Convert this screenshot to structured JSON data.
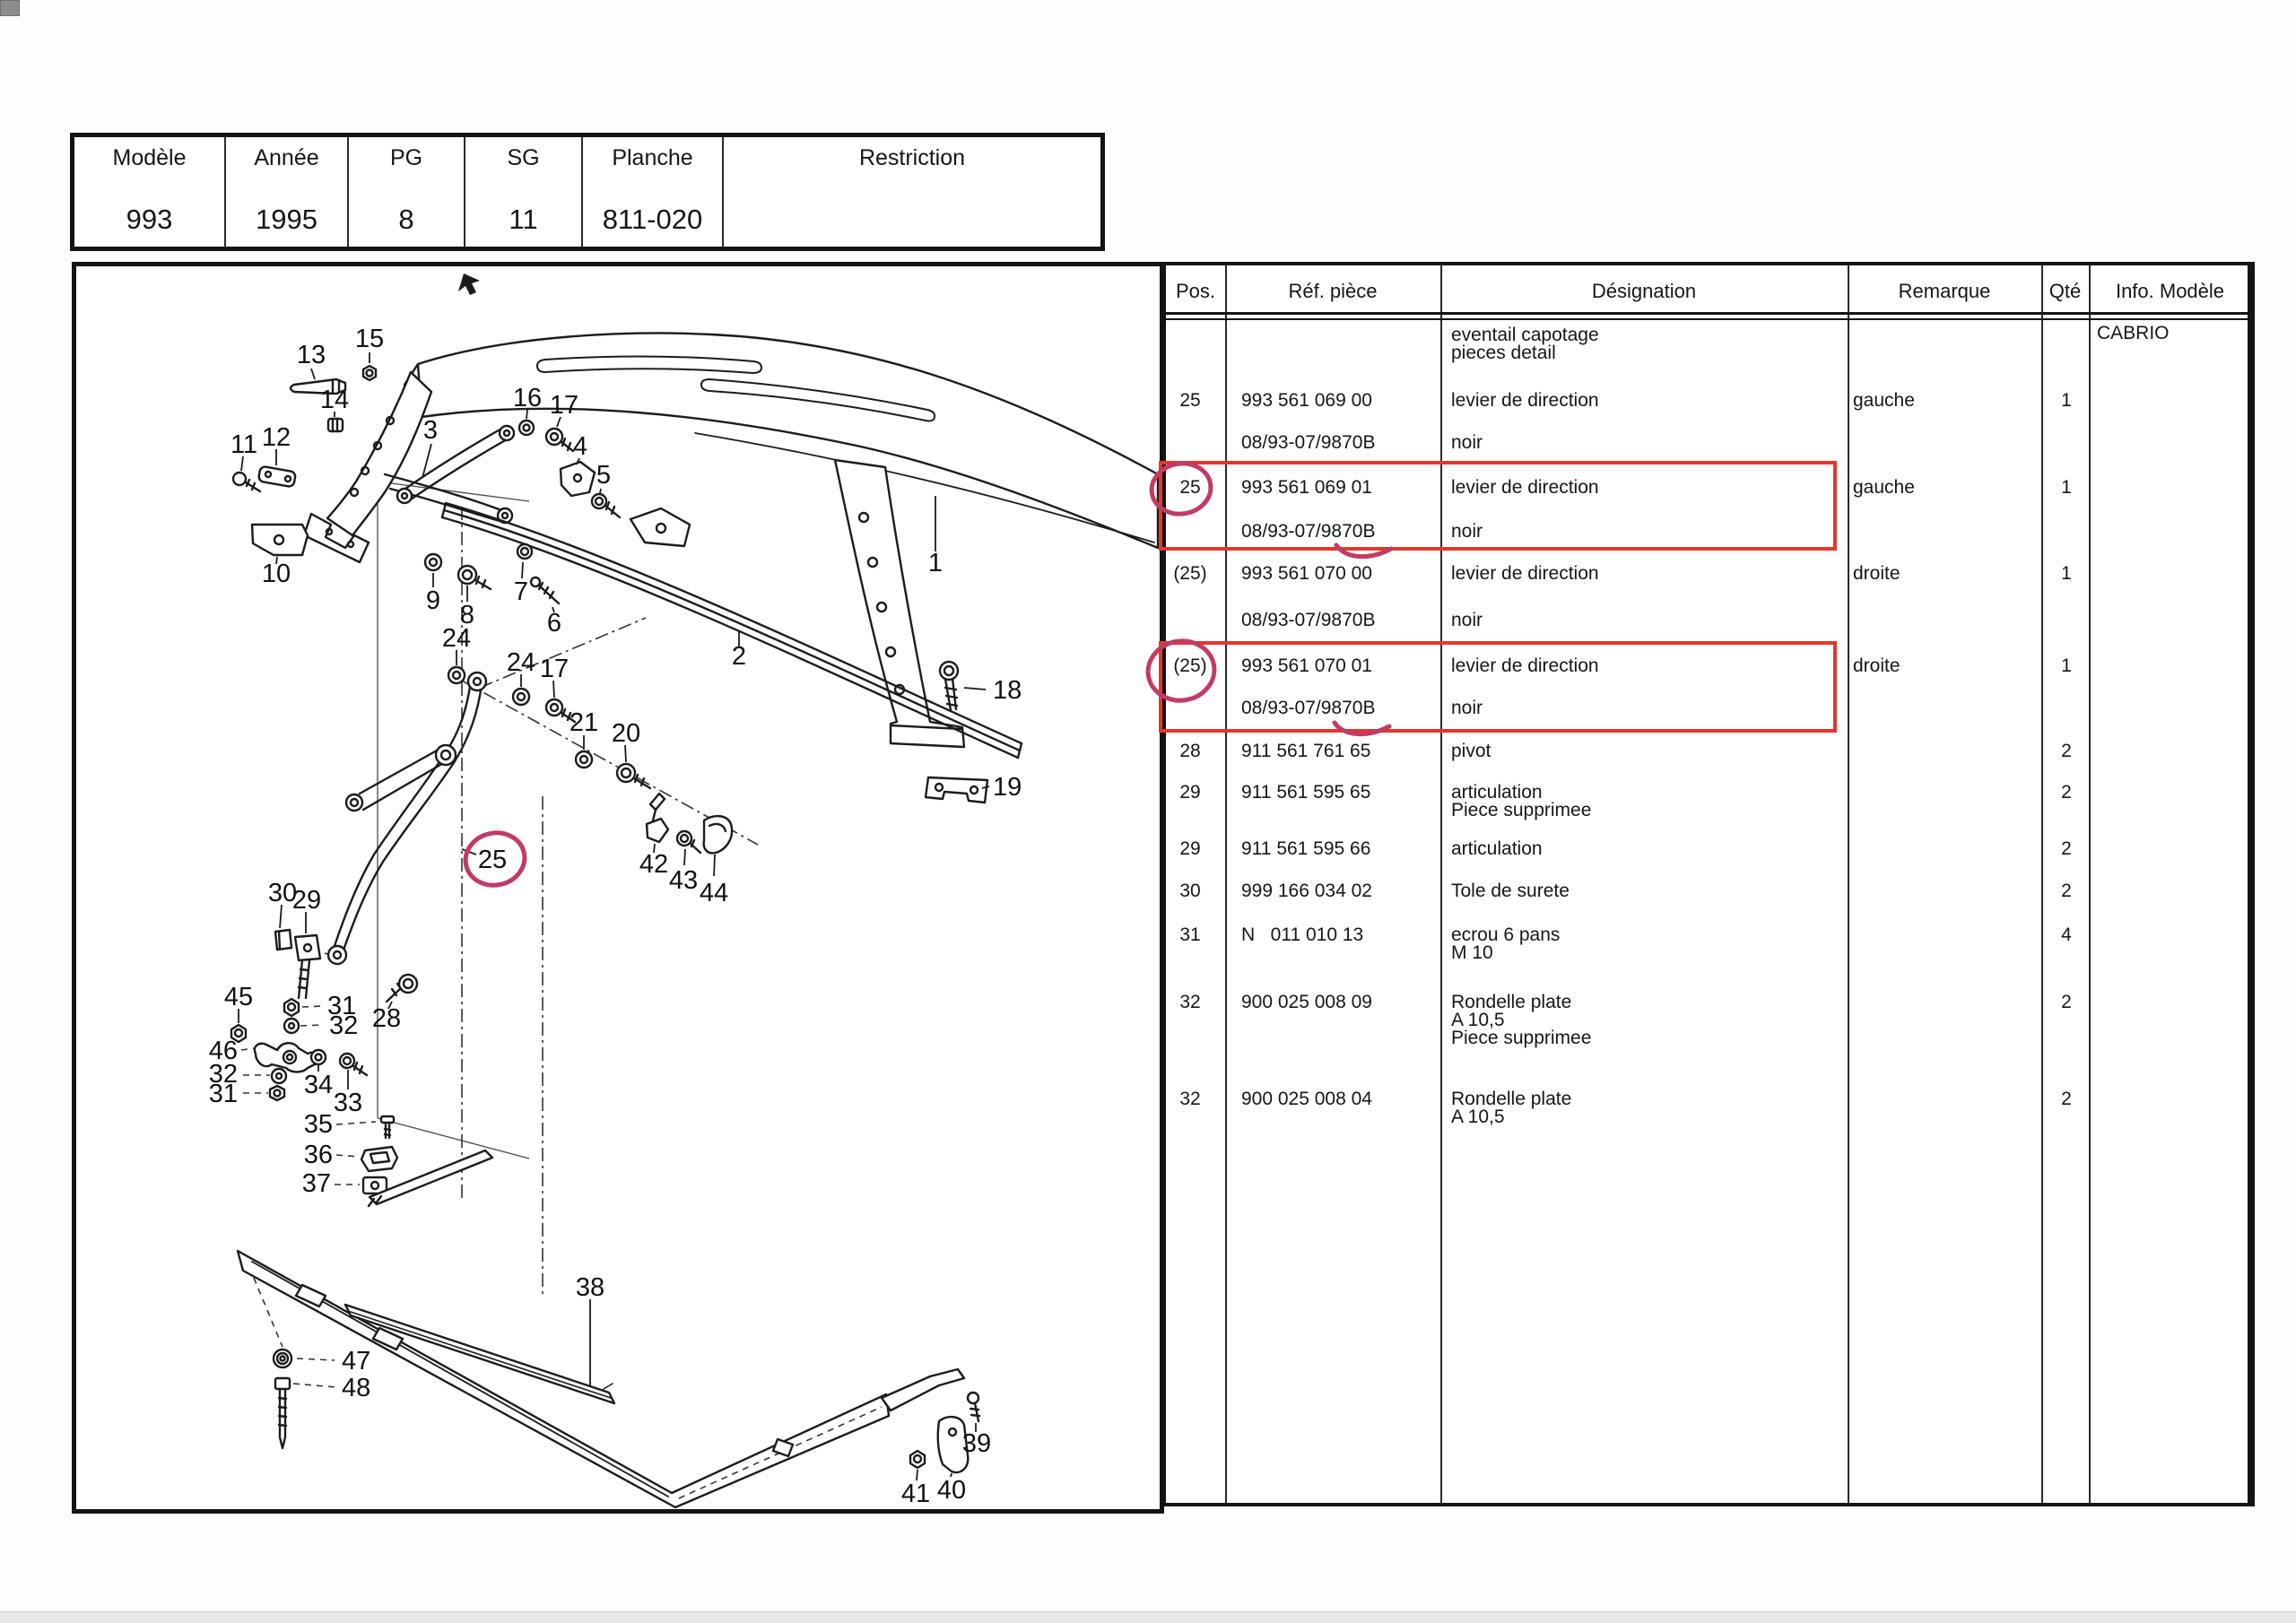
{
  "title_block": {
    "cells": [
      {
        "label": "Modèle",
        "value": "993"
      },
      {
        "label": "Année",
        "value": "1995"
      },
      {
        "label": "PG",
        "value": "8"
      },
      {
        "label": "SG",
        "value": "11"
      },
      {
        "label": "Planche",
        "value": "811-020"
      },
      {
        "label": "Restriction",
        "value": ""
      }
    ]
  },
  "parts_table": {
    "headers": {
      "pos": "Pos.",
      "ref": "Réf. pièce",
      "des": "Désignation",
      "remark": "Remarque",
      "qty": "Qté",
      "info": "Info. Modèle"
    },
    "rows": [
      {
        "des1": "eventail capotage",
        "des2": "pieces detail",
        "info": "CABRIO"
      },
      {
        "pos": "25",
        "ref": "993 561 069 00",
        "des1": "levier de direction",
        "remark": "gauche",
        "qty": "1"
      },
      {
        "ref": "08/93-07/9870B",
        "des1": "noir"
      },
      {
        "pos": "25",
        "ref": "993 561 069 01",
        "des1": "levier de direction",
        "remark": "gauche",
        "qty": "1"
      },
      {
        "ref": "08/93-07/9870B",
        "des1": "noir"
      },
      {
        "pos": "(25)",
        "ref": "993 561 070 00",
        "des1": "levier de direction",
        "remark": "droite",
        "qty": "1"
      },
      {
        "ref": "08/93-07/9870B",
        "des1": "noir"
      },
      {
        "pos": "(25)",
        "ref": "993 561 070 01",
        "des1": "levier de direction",
        "remark": "droite",
        "qty": "1"
      },
      {
        "ref": "08/93-07/9870B",
        "des1": "noir"
      },
      {
        "pos": "28",
        "ref": "911 561 761 65",
        "des1": "pivot",
        "qty": "2"
      },
      {
        "pos": "29",
        "ref": "911 561 595 65",
        "des1": "articulation",
        "des2": "Piece supprimee",
        "qty": "2"
      },
      {
        "pos": "29",
        "ref": "911 561 595 66",
        "des1": "articulation",
        "qty": "2"
      },
      {
        "pos": "30",
        "ref": "999 166 034 02",
        "des1": "Tole de surete",
        "qty": "2"
      },
      {
        "pos": "31",
        "ref": "N   011 010 13",
        "des1": "ecrou 6 pans",
        "des2": "M 10",
        "qty": "4"
      },
      {
        "pos": "32",
        "ref": "900 025 008 09",
        "des1": "Rondelle plate",
        "des2": "A 10,5",
        "des3": "Piece supprimee",
        "qty": "2"
      },
      {
        "pos": "32",
        "ref": "900 025 008 04",
        "des1": "Rondelle plate",
        "des2": "A 10,5",
        "qty": "2"
      }
    ]
  },
  "diagram": {
    "labels": [
      "13",
      "15",
      "14",
      "16",
      "17",
      "3",
      "11",
      "12",
      "4",
      "5",
      "1",
      "10",
      "9",
      "8",
      "7",
      "6",
      "2",
      "18",
      "19",
      "24",
      "24",
      "17",
      "21",
      "20",
      "25",
      "42",
      "43",
      "44",
      "30",
      "29",
      "45",
      "31",
      "32",
      "28",
      "46",
      "32",
      "31",
      "34",
      "33",
      "35",
      "36",
      "37",
      "38",
      "47",
      "48",
      "41",
      "40",
      "39"
    ]
  },
  "annotations": {
    "box_color": "#e6362c",
    "hand_color": "#c23b63",
    "circled_positions": [
      "25",
      "(25)"
    ],
    "boxed_refs": [
      "993 561 069 01",
      "993 561 070 01"
    ]
  }
}
